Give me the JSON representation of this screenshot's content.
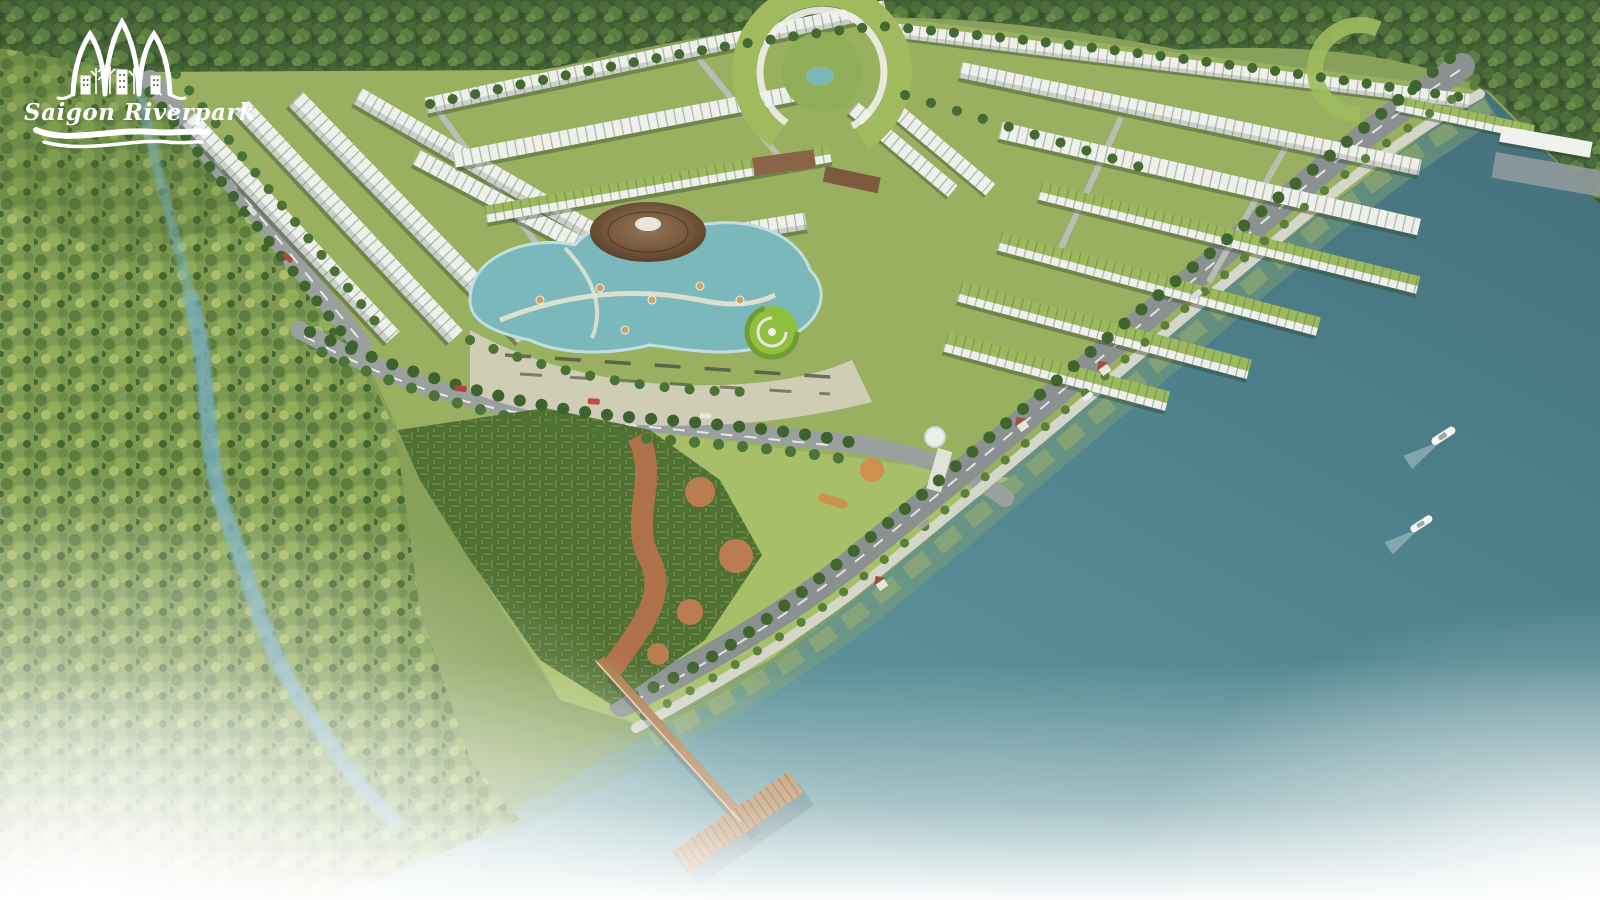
{
  "branding": {
    "project_name": "Saigon Riverpark",
    "logo_icon": "lotus-arches-icon",
    "logo_swoosh_icon": "river-swoosh-icon",
    "logo_color": "#ffffff"
  },
  "scene": {
    "type": "aerial-masterplan-render",
    "boat_count": 2,
    "colors": {
      "water": "#4f838d",
      "water_deep": "#446f7b",
      "lagoon": "#7ab8bc",
      "forest_dark": "#3f5c33",
      "palm_forest": "#7d9a52",
      "estate_ground": "#9ab061",
      "lawn": "#a6bf68",
      "plaza": "#d8d4c4",
      "road": "#8b9190",
      "promenade": "#d3d6c8",
      "roof_white": "#eef0ea",
      "roof_green": "#9cb95c",
      "hedge": "#4f7030",
      "maze_path": "#b4714b",
      "pavilion_roof": "#7a5b3e",
      "pier_wood": "#a97a45",
      "boat": "#f4f6f4",
      "creek": "#79aebe"
    }
  }
}
